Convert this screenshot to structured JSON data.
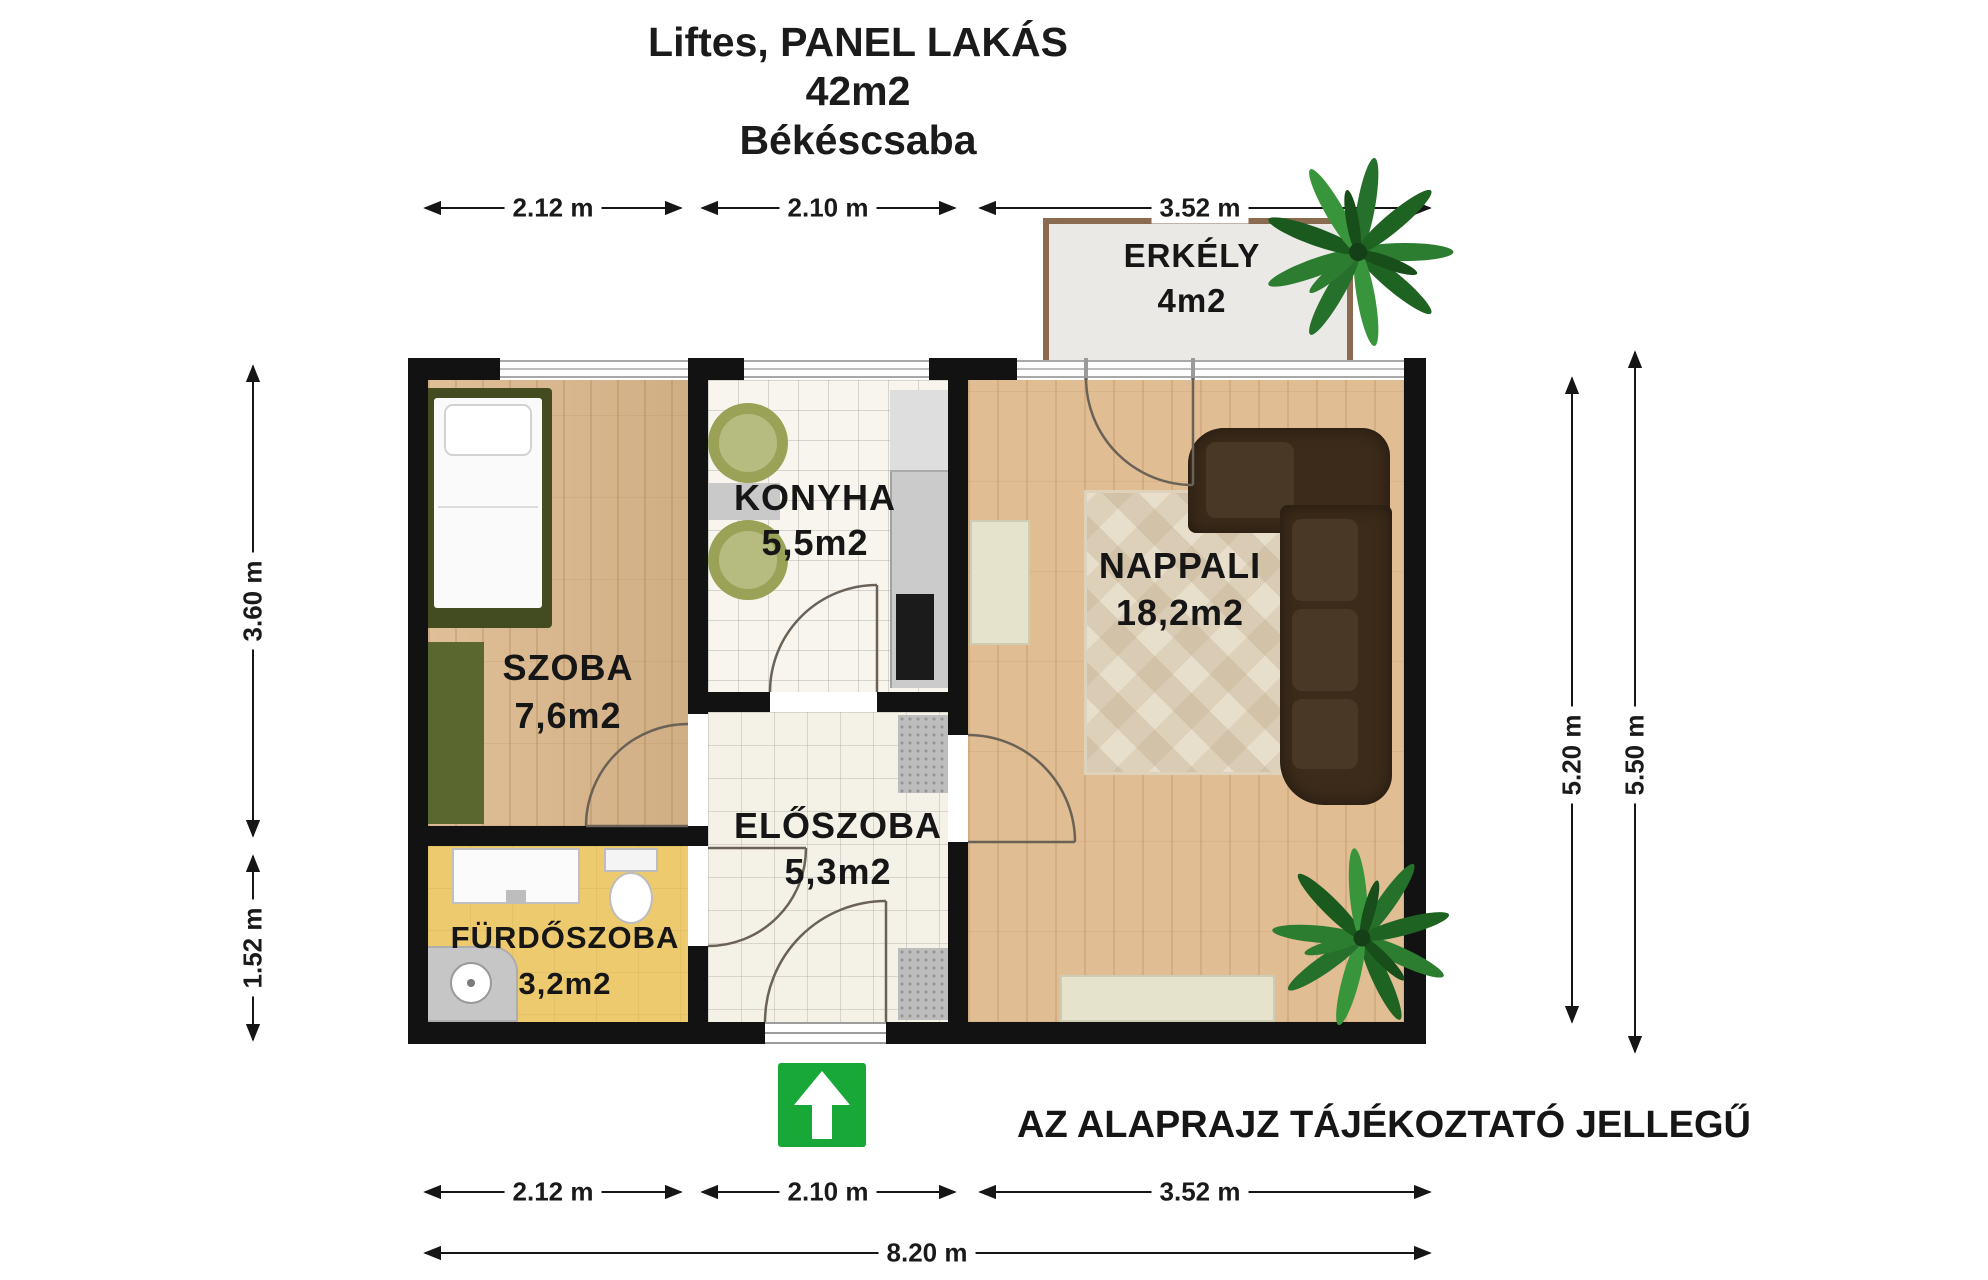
{
  "title": {
    "line1": "Liftes, PANEL LAKÁS",
    "line2": "42m2",
    "line3": "Békéscsaba"
  },
  "disclaimer": "AZ ALAPRAJZ TÁJÉKOZTATÓ JELLEGŰ",
  "rooms": [
    {
      "id": "erkely",
      "name": "ERKÉLY",
      "area": "4m2"
    },
    {
      "id": "szoba",
      "name": "SZOBA",
      "area": "7,6m2"
    },
    {
      "id": "konyha",
      "name": "KONYHA",
      "area": "5,5m2"
    },
    {
      "id": "nappali",
      "name": "NAPPALI",
      "area": "18,2m2"
    },
    {
      "id": "eloszoba",
      "name": "ELŐSZOBA",
      "area": "5,3m2"
    },
    {
      "id": "furdoszoba",
      "name": "FÜRDŐSZOBA",
      "area": "3,2m2"
    }
  ],
  "dimensions": {
    "top": [
      "2.12 m",
      "2.10 m",
      "3.52 m"
    ],
    "bottom": [
      "2.12 m",
      "2.10 m",
      "3.52 m"
    ],
    "total_width": "8.20 m",
    "left": [
      "3.60 m",
      "1.52 m"
    ],
    "right": [
      "5.20 m",
      "5.50 m"
    ]
  },
  "icons": {
    "entrance_arrow": "up-arrow"
  },
  "colors": {
    "wall": "#121212",
    "wood_floor": "#dcb88c",
    "tile_floor": "#f7f5ee",
    "bathroom_floor": "#edca6e",
    "balcony_floor": "#ebe9e6",
    "balcony_border": "#8a6a50",
    "sofa": "#3c2b1a",
    "entrance_green": "#18a838"
  }
}
